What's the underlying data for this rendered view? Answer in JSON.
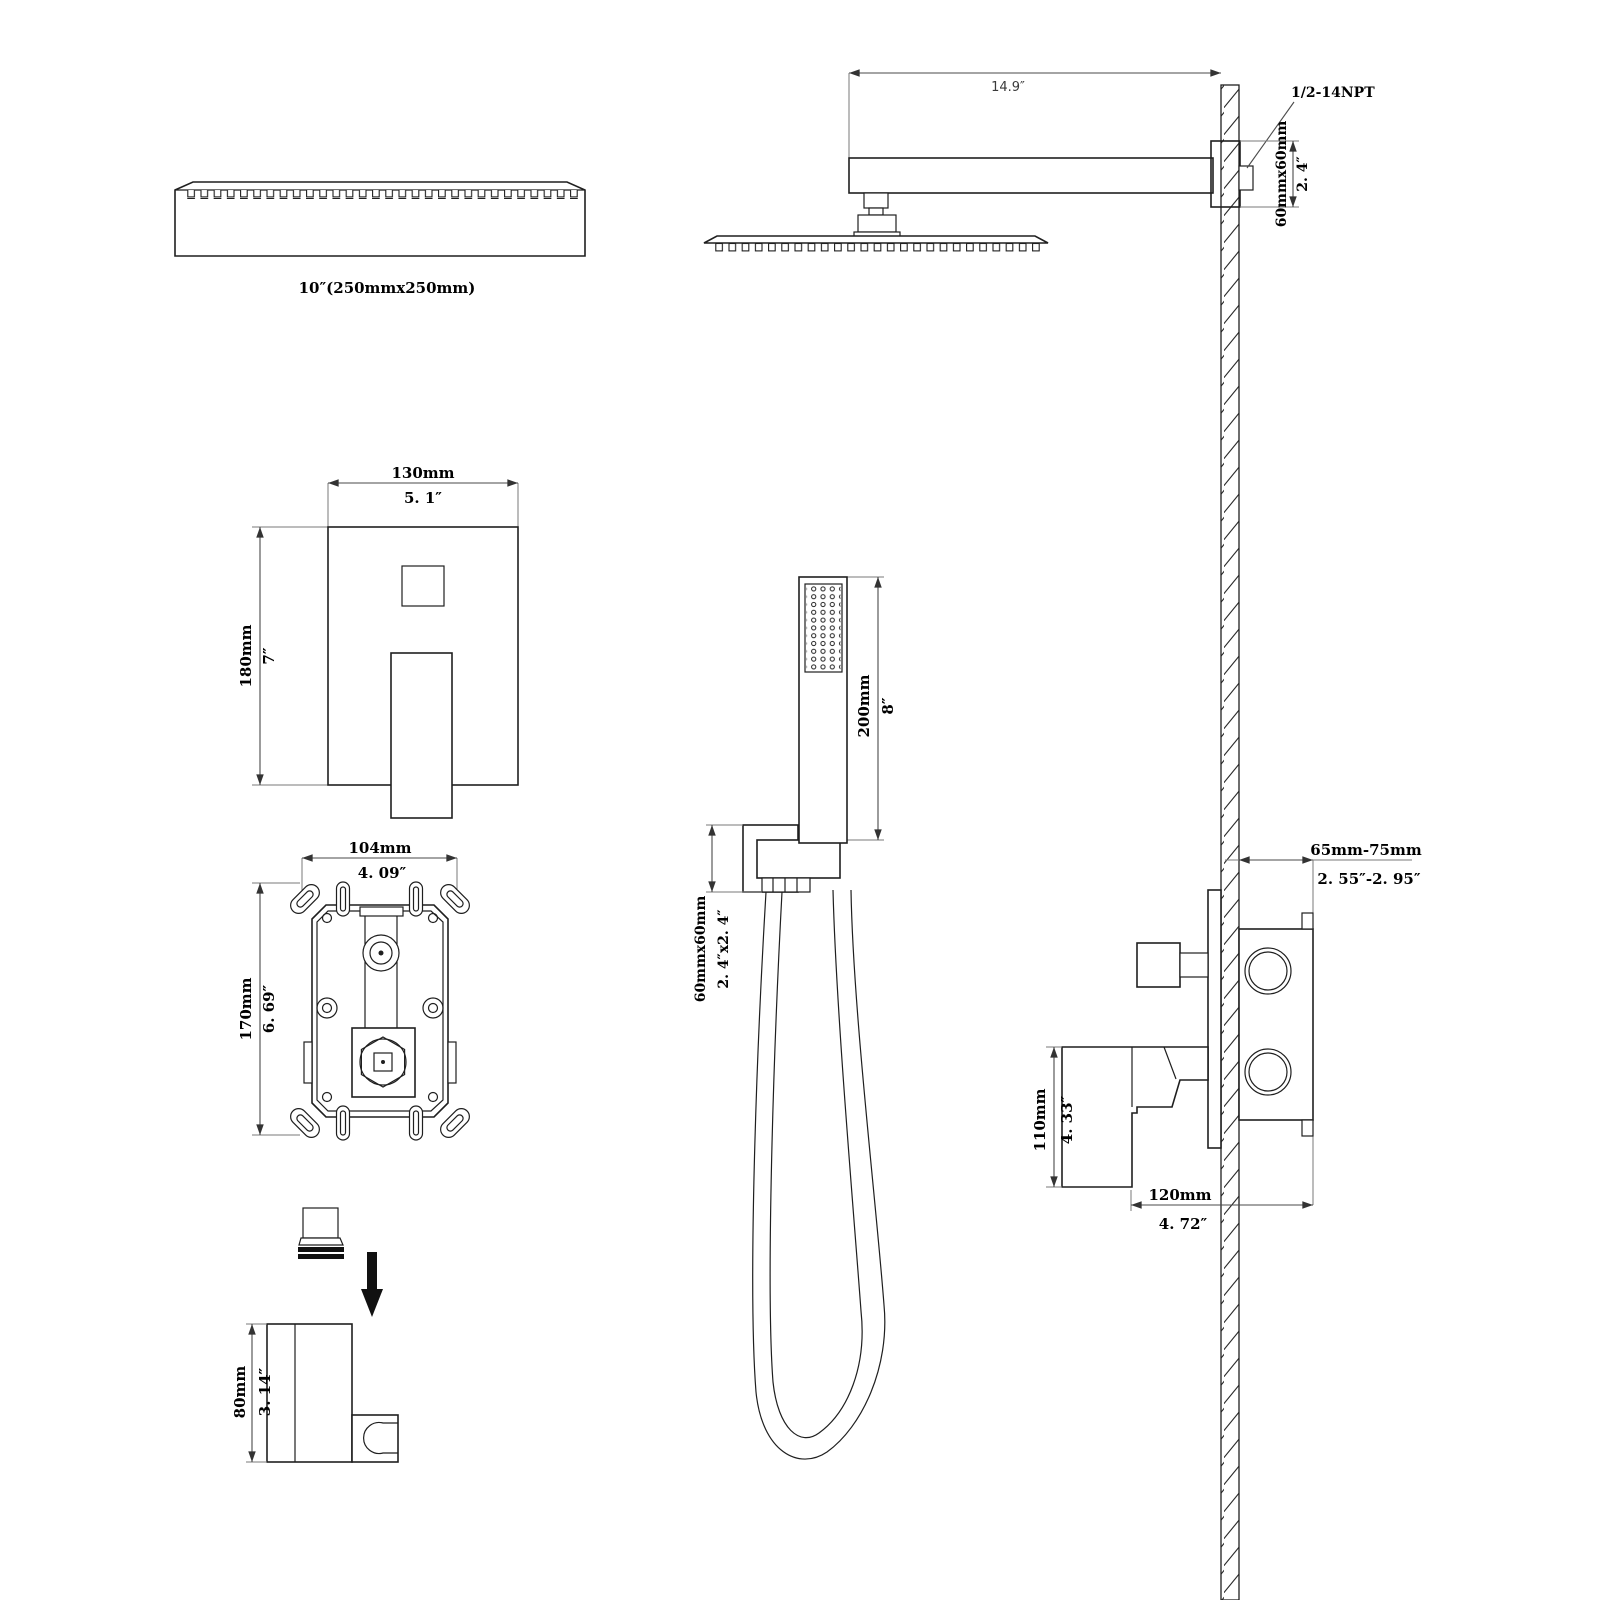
{
  "drawing": {
    "background": "#ffffff",
    "line_color": "#1f1f1f",
    "dim_color": "#000000",
    "views": {
      "head_side": {
        "label": "10″(250mmx250mm)"
      },
      "arm_side": {
        "arm_length": "14.9″",
        "thread_spec": "1/2-14NPT",
        "flange_mm": "60mmx60mm",
        "flange_in": "2. 4″"
      },
      "trim_plate": {
        "width_mm": "130mm",
        "width_in": "5. 1″",
        "height_mm": "180mm",
        "height_in": "7″"
      },
      "valve_front": {
        "width_mm": "104mm",
        "width_in": "4. 09″",
        "height_mm": "170mm",
        "height_in": "6. 69″"
      },
      "handshower": {
        "length_mm": "200mm",
        "length_in": "8″",
        "holder_mm": "60mmx60mm",
        "holder_in": "2. 4″x2. 4″"
      },
      "valve_side": {
        "depth_mm": "65mm-75mm",
        "depth_in": "2. 55″-2. 95″",
        "handle_mm": "110mm",
        "handle_in": "4. 33″",
        "width_mm": "120mm",
        "width_in": "4. 72″"
      },
      "bracket": {
        "height_mm": "80mm",
        "height_in": "3. 14″"
      }
    }
  }
}
